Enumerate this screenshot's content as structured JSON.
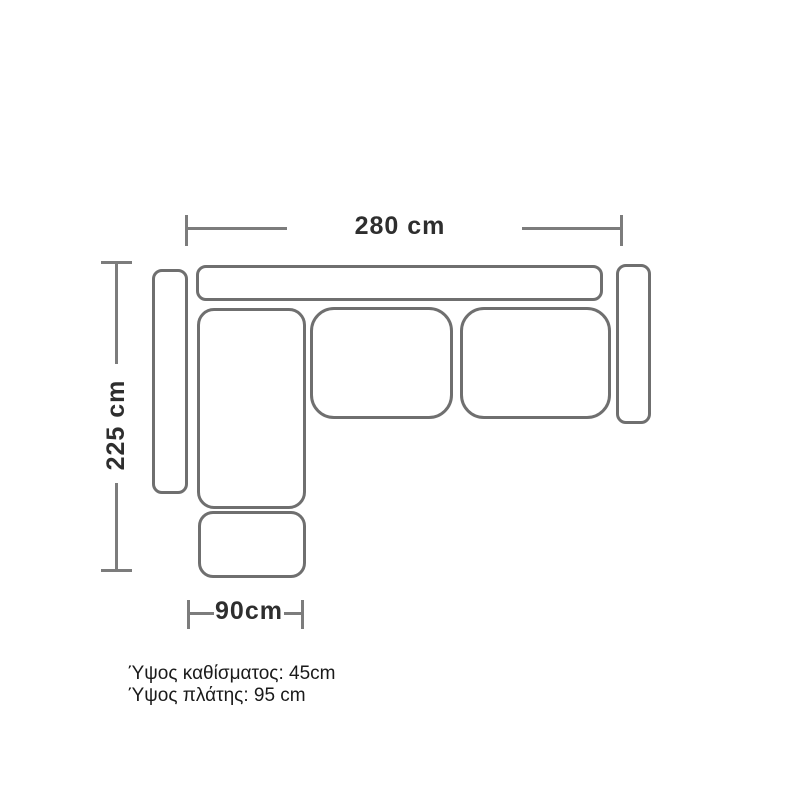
{
  "diagram": {
    "type": "sofa-top-view-dimension-drawing",
    "labels": {
      "width": "280 cm",
      "depth": "225 cm",
      "chaise_width": "90cm"
    },
    "notes": {
      "seat_height": "Ύψος καθίσματος: 45cm",
      "back_height": "Ύψος πλάτης: 95 cm"
    },
    "parts": [
      "backrest",
      "left-armrest",
      "right-armrest",
      "chaise-seat",
      "middle-seat-cushion",
      "right-seat-cushion",
      "footstool"
    ],
    "colors": {
      "outline": "#6f6f6f",
      "dimension_line": "#7c7c7c",
      "dimension_text": "#2e2e2e",
      "note_text": "#1a1a1a",
      "background": "#ffffff"
    }
  }
}
